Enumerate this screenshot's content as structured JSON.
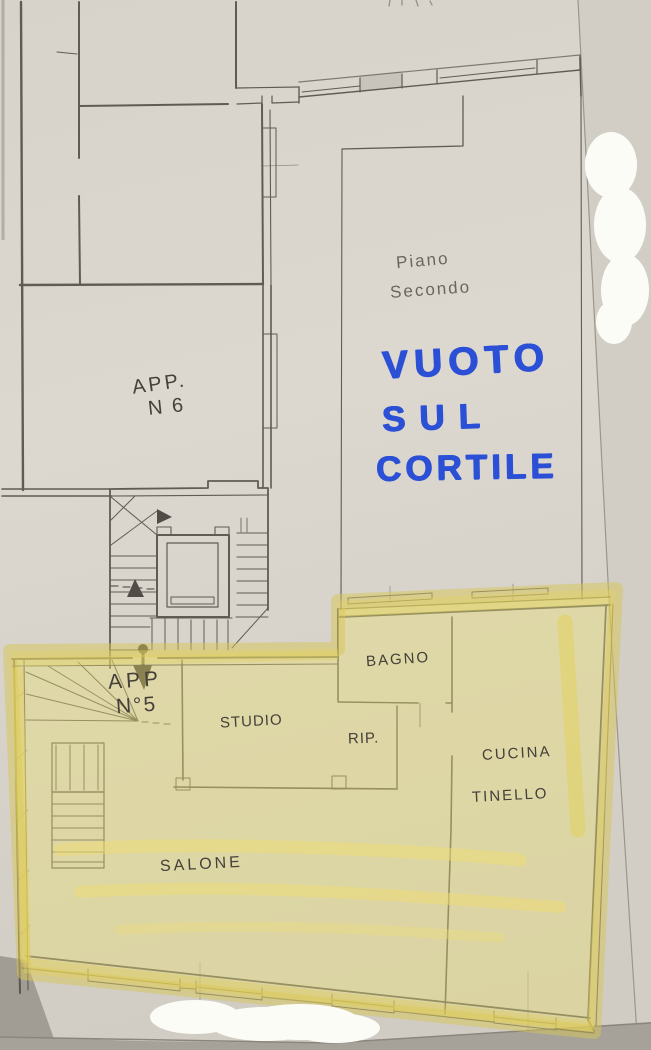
{
  "annotations": {
    "floor_note": {
      "line1": "Piano",
      "line2": "Secondo"
    },
    "marker_note": {
      "line1": "VUOTO",
      "line2": "SUL",
      "line3": "CORTILE"
    }
  },
  "rooms": {
    "apartment6": {
      "line1": "APP.",
      "line2": "N 6"
    },
    "apartment5": {
      "line1": "APP",
      "line2": "N°5"
    },
    "bathroom": "BAGNO",
    "study": "STUDIO",
    "closet": "RIP.",
    "kitchen_line1": "CUCINA",
    "kitchen_line2": "TINELLO",
    "living_room": "SALONE"
  },
  "colors": {
    "marker_blue": "#2b50d6",
    "pencil": "#55514a",
    "highlight_yellow": "#ebdf70",
    "whiteout": "#fcfcf7",
    "paper": "#d8d4cc",
    "backdrop_gray": "#a7a299"
  }
}
